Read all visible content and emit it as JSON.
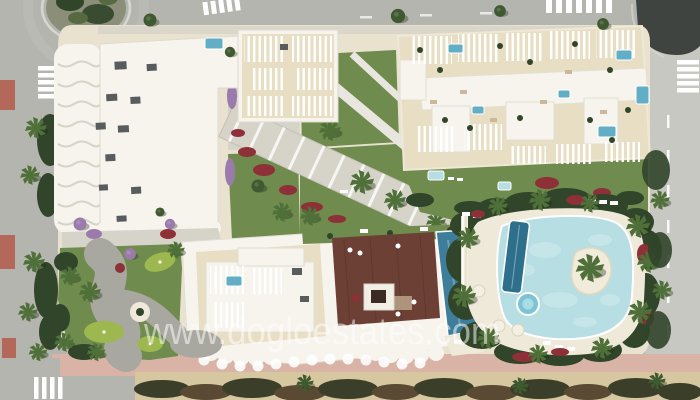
{
  "watermark": {
    "text": "www.dogloestates.com"
  },
  "palette": {
    "road": "#b4b5af",
    "road_right": "#c7c8c2",
    "asphalt_dark": "#3f4441",
    "sidewalk": "#d3d1c7",
    "sidewalk_pink": "#d9b3a5",
    "red_tile": "#b4685a",
    "sand": "#d7c7a1",
    "bush_dark": "#3b3f2a",
    "deck_cream": "#e9e2cf",
    "deck_light": "#efe9da",
    "terrace_sand": "#e8dec4",
    "roof_white": "#f6f4ec",
    "path_gray": "#a9a8a0",
    "path_light": "#d6d3c9",
    "lawn": "#6f8b4e",
    "putting_green": "#9cb84f",
    "hedge": "#30452a",
    "palm": "#4f7038",
    "flower_red": "#8d3038",
    "flower_purple": "#9a7bab",
    "pool_lagoon": "#b6dee3",
    "pool_mid": "#62aec6",
    "pool_dark": "#2e6f8c",
    "pool_roof": "#3f7e9b",
    "wood_deck": "#6d4036",
    "ac_gray": "#585c5e",
    "watermark": "#ffffff"
  }
}
